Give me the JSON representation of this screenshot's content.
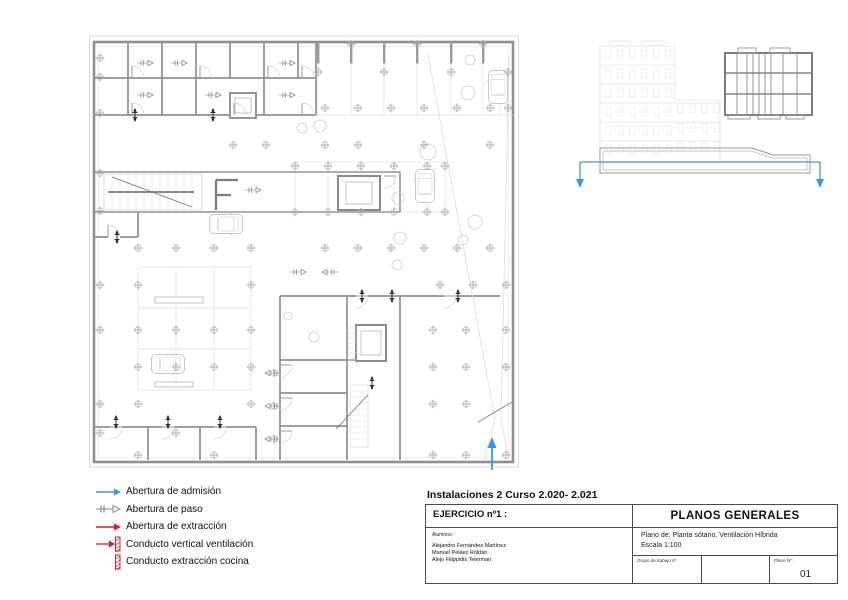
{
  "colors": {
    "accent_blue": "#3b96e8",
    "accent_red": "#e01b1b",
    "wall_gray": "#8f8f8f",
    "line_gray": "#dedede"
  },
  "legend": {
    "items": [
      {
        "label": "Abertura de admisión",
        "symbol": "admission-arrow",
        "color": "#3b96e8"
      },
      {
        "label": "Abertura de paso",
        "symbol": "passage-arrow",
        "color": "#9a9a9a"
      },
      {
        "label": "Abertura de extracción",
        "symbol": "extraction-arrow",
        "color": "#e01b1b"
      },
      {
        "label": "Conducto vertical ventilación",
        "symbol": "vertical-duct",
        "color": "#e01b1b"
      },
      {
        "label": "Conducto extracción cocina",
        "symbol": "kitchen-extraction-duct",
        "color": "#e01b1b"
      }
    ]
  },
  "title_block": {
    "course_title": "Instalaciones 2  Curso 2.020- 2.021",
    "exercise_label": "EJERCICIO nº1 :",
    "sheet_title": "PLANOS GENERALES",
    "students_label": "Alumnos:",
    "students": [
      "Alejandro Fernández Martínez",
      "Manuel Peláez Roldán",
      "Alejo Filippidis Telerman"
    ],
    "plan_description": "Plano de: Planta sótano. Ventilación Híbrida",
    "scale": "Escala 1:100",
    "work_group_label": "Grupo de trabajo nº:",
    "sheet_number_label": "Plano Nº:",
    "sheet_number": "01"
  }
}
